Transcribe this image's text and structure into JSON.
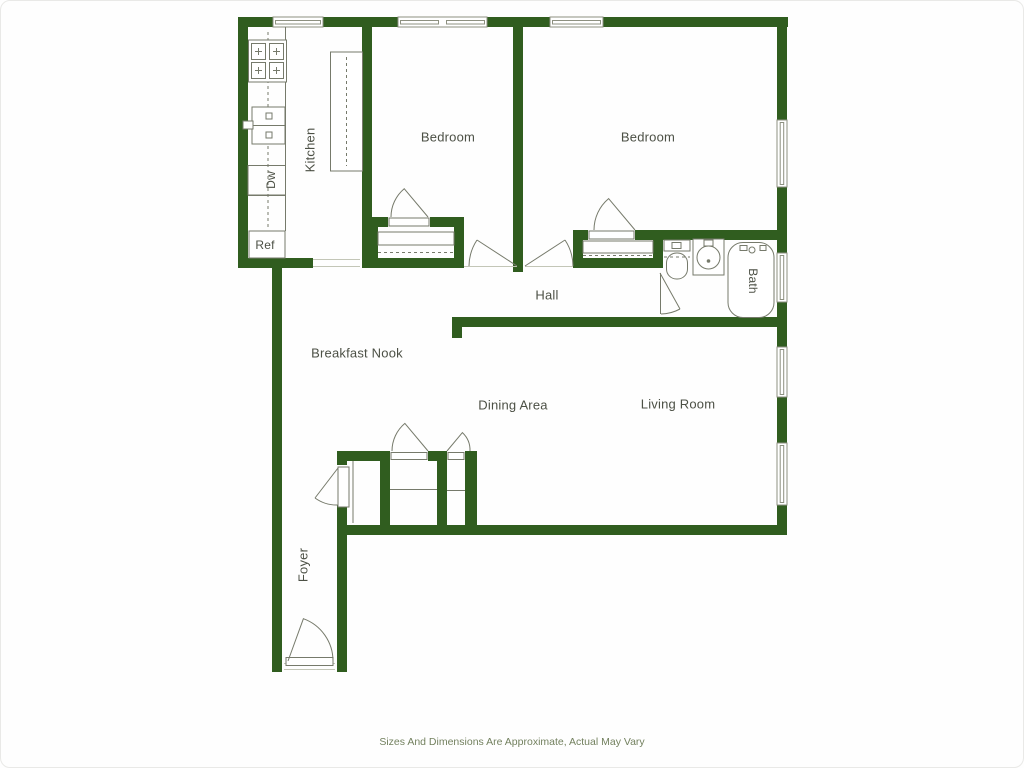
{
  "plan": {
    "rooms": {
      "bedroom1": "Bedroom",
      "bedroom2": "Bedroom",
      "kitchen": "Kitchen",
      "hall": "Hall",
      "breakfast_nook": "Breakfast Nook",
      "dining_area": "Dining Area",
      "living_room": "Living Room",
      "foyer": "Foyer",
      "bath": "Bath"
    },
    "fixtures": {
      "refrigerator": "Ref",
      "dishwasher": "Dw"
    },
    "caption": "Sizes And Dimensions Are Approximate, Actual May Vary",
    "colors": {
      "wall": "#305d1f",
      "fixture_line": "#767a6b",
      "label": "#4c5045",
      "caption": "#73815f"
    }
  }
}
